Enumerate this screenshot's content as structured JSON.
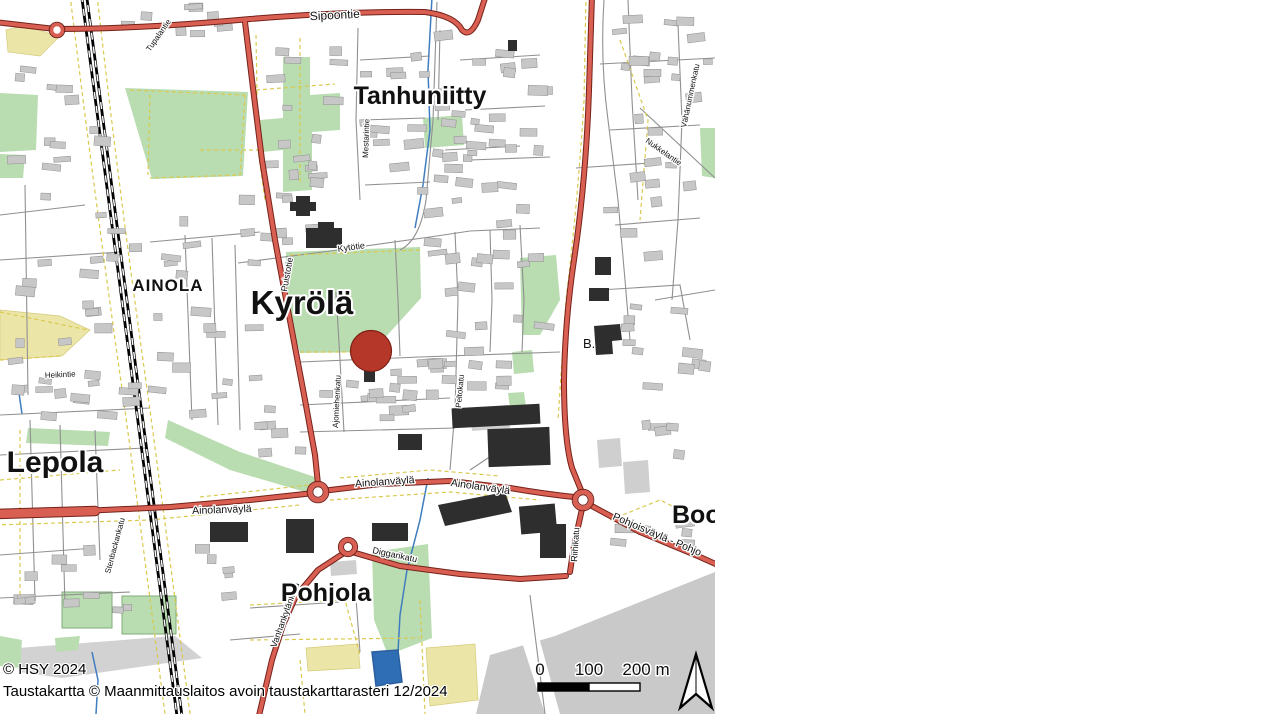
{
  "map": {
    "district_labels": {
      "tanhuniitty": "Tanhuniitty",
      "ainola": "AINOLA",
      "kyrola": "Kyrölä",
      "lepola": "Lepola",
      "pohjola": "Pohjola",
      "boo": "Boog",
      "b_dot": "B."
    },
    "road_labels": {
      "sipoontie": "Sipoontie",
      "puistotie": "Puistotie",
      "ainolanvayla_w": "Ainolanväylä",
      "ainolanvayla_e1": "Ainolanväylä",
      "ainolanvayla_e2": "Ainolanväylä",
      "pohjoisvayla": "Pohjoisväylä - Pohjo",
      "riihikatu": "Riihikatu",
      "vanhankylankatu": "Vanhankylänkatu",
      "diggarikatu": "Diggarikatu",
      "kytotie": "Kytötie",
      "ajomiehenkatu": "Ajomiehenkatu",
      "peltokatu": "Peltokatu",
      "mestarintie": "Mestarintie",
      "tupalantie": "Tupalantie",
      "vahanummenkatu": "Vähänummenkatu",
      "nukkelantie": "Nukkelantie",
      "stenbackankatu": "Stenbackankatu",
      "heikintie": "Heikintie"
    },
    "scale_bar": {
      "tick0": "0",
      "tick100": "100",
      "tick200": "200 m"
    },
    "attribution_line1": "© HSY 2024",
    "attribution_line2": "Taustakartta © Maanmittauslaitos avoin taustakarttarasteri 12/2024",
    "marker": {
      "color": "#b5372a"
    },
    "colors": {
      "main_road": "#d95f52",
      "road_casing": "#74221a",
      "minor_road": "#909090",
      "path_yellow": "#d9c94f",
      "park_green": "#b9dcb1",
      "field_yellow": "#ece5a8",
      "water_blue": "#3f7dc0",
      "building_gray": "#c7c7c7",
      "building_black": "#2e2e2e",
      "flat_gray": "#c9c9c9"
    }
  }
}
